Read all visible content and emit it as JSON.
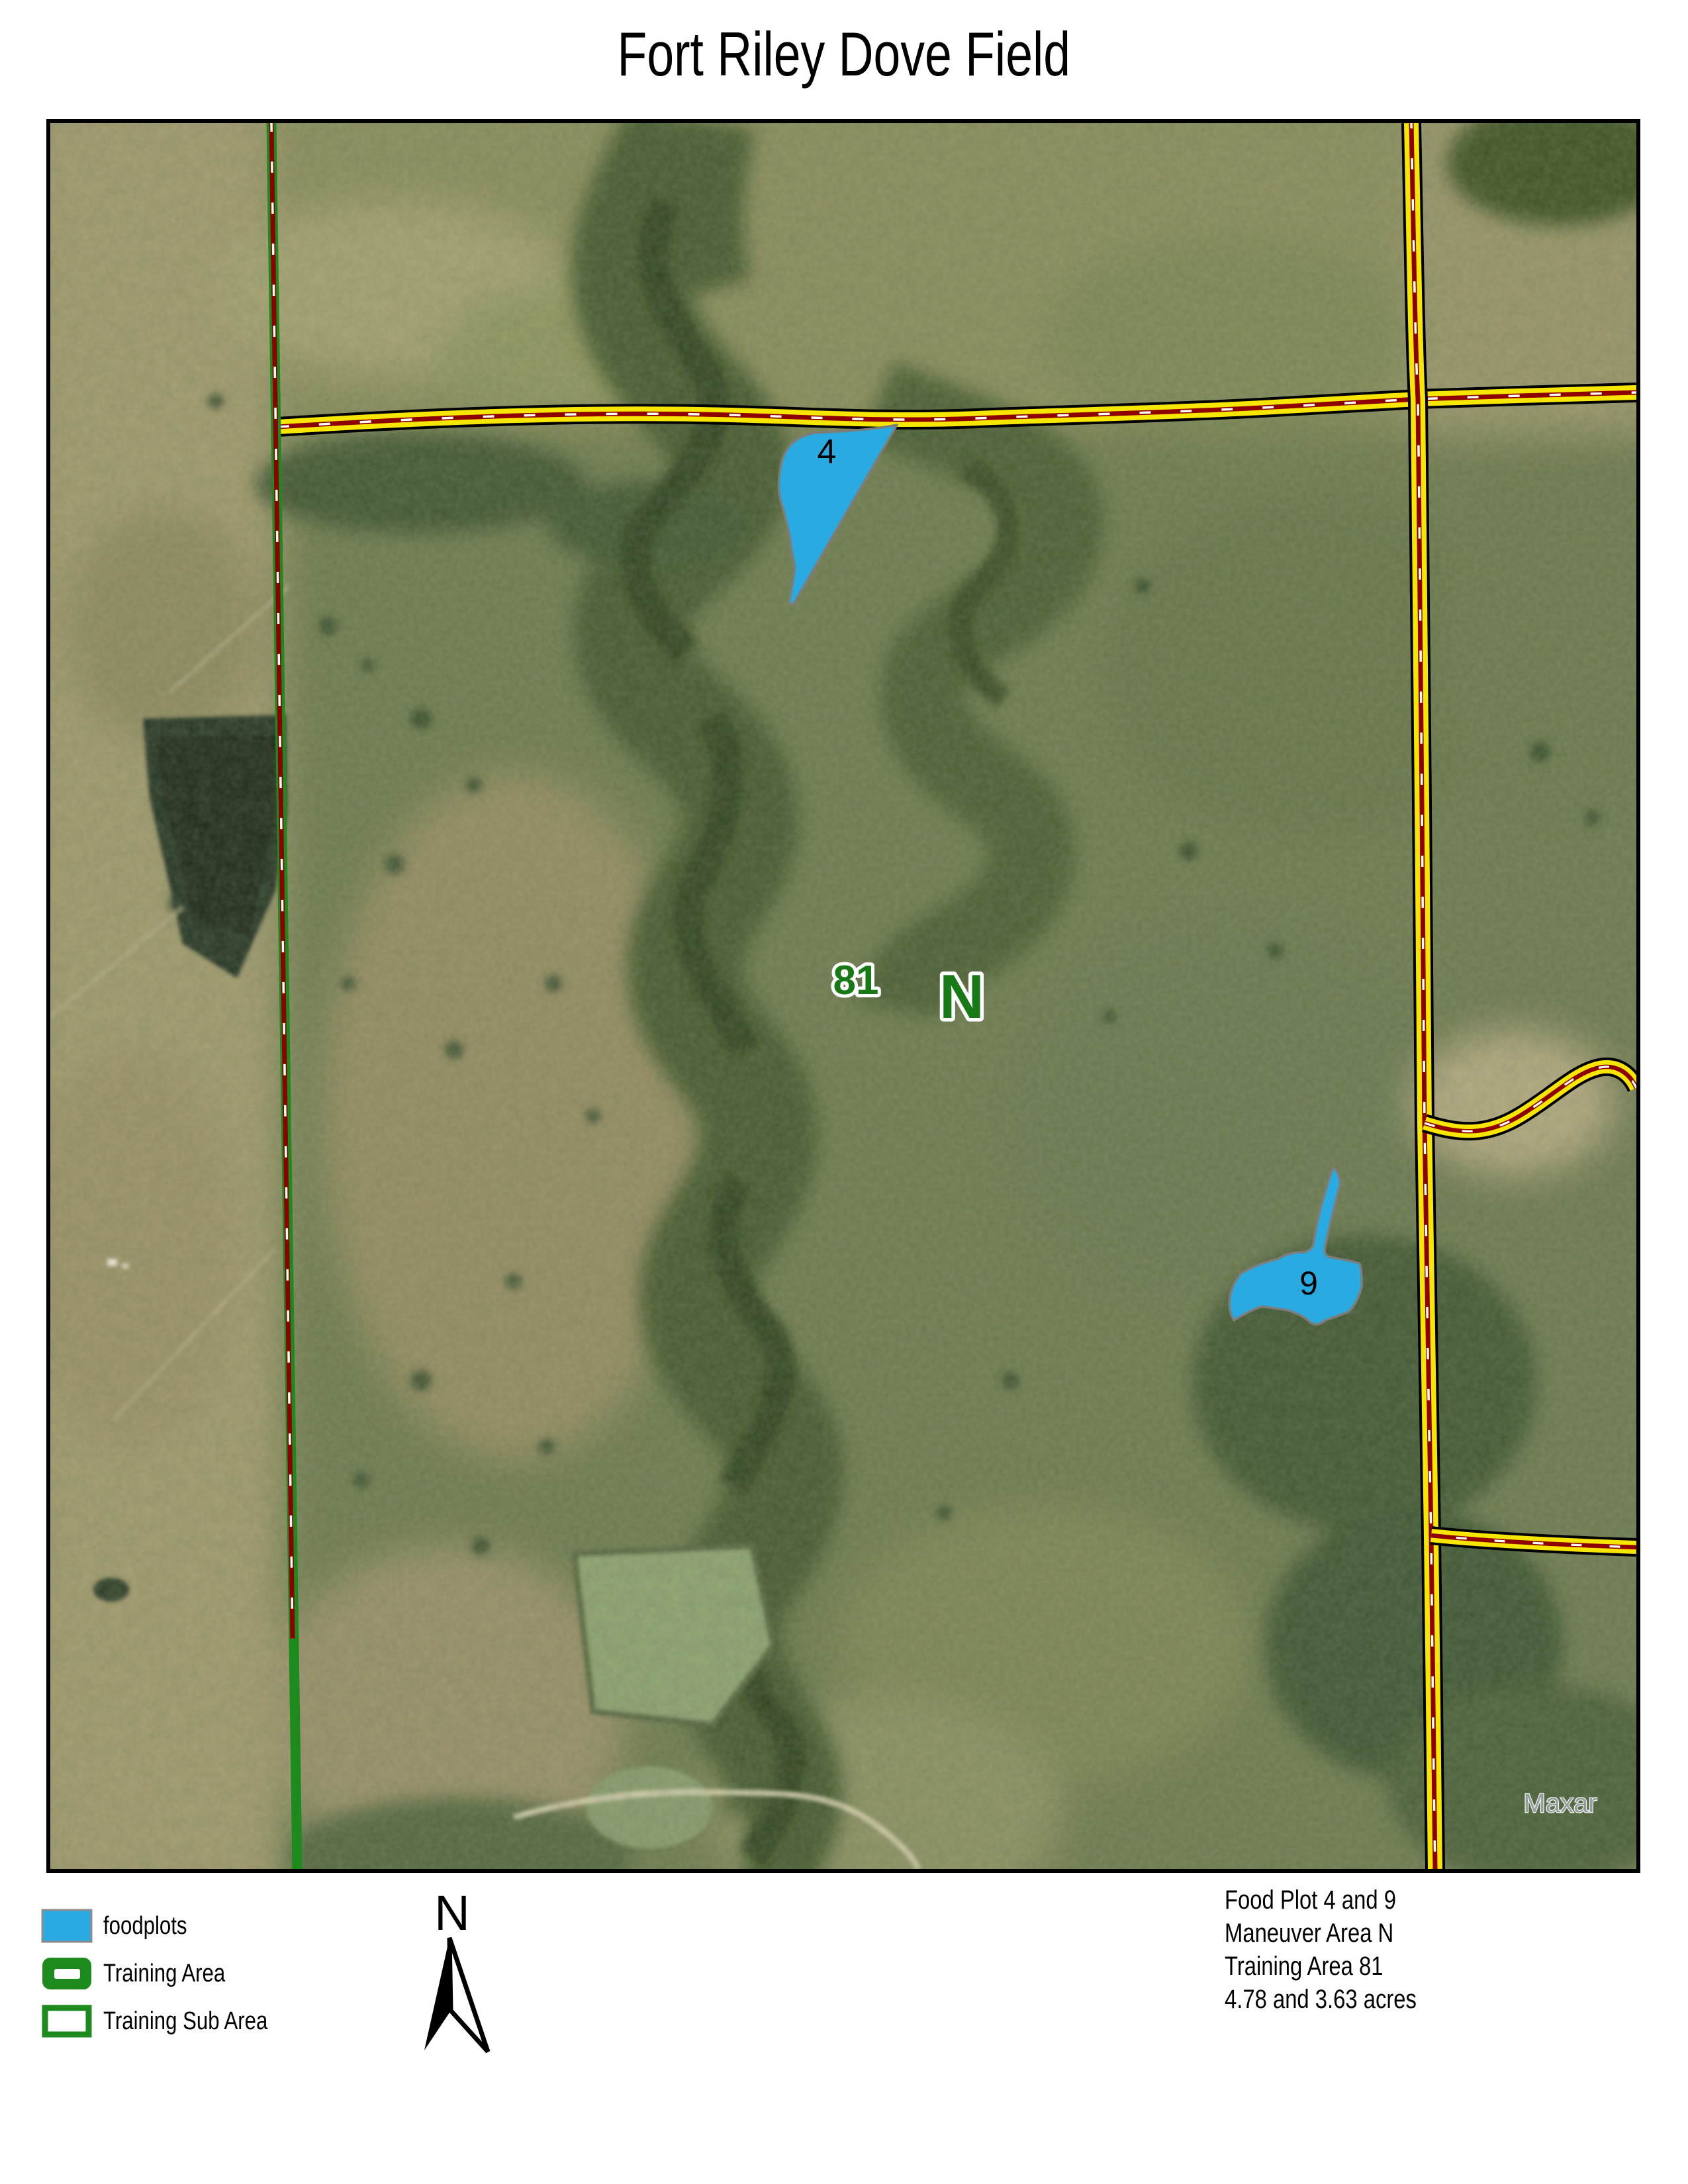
{
  "title": "Fort Riley Dove Field",
  "map": {
    "labels": {
      "plot4": "4",
      "plot9": "9",
      "training_area": "81",
      "maneuver_area": "N"
    },
    "watermark": "Maxar"
  },
  "legend": {
    "items": [
      {
        "label": "foodplots"
      },
      {
        "label": "Training Area"
      },
      {
        "label": "Training Sub Area"
      }
    ]
  },
  "north_arrow": {
    "label": "N"
  },
  "annotation": {
    "lines": [
      "Food Plot 4 and 9",
      "Maneuver Area N",
      "Training Area 81",
      "4.78 and 3.63 acres"
    ]
  },
  "colors": {
    "foodplot": "#29abe2",
    "foodplot_outline": "#7d7d7d",
    "training_green": "#1c8a1c",
    "label_green": "#177a17",
    "road_yellow": "#f7e600",
    "road_casing": "#000000",
    "road_center": "#8e0000",
    "road_dash": "#ffffff"
  }
}
